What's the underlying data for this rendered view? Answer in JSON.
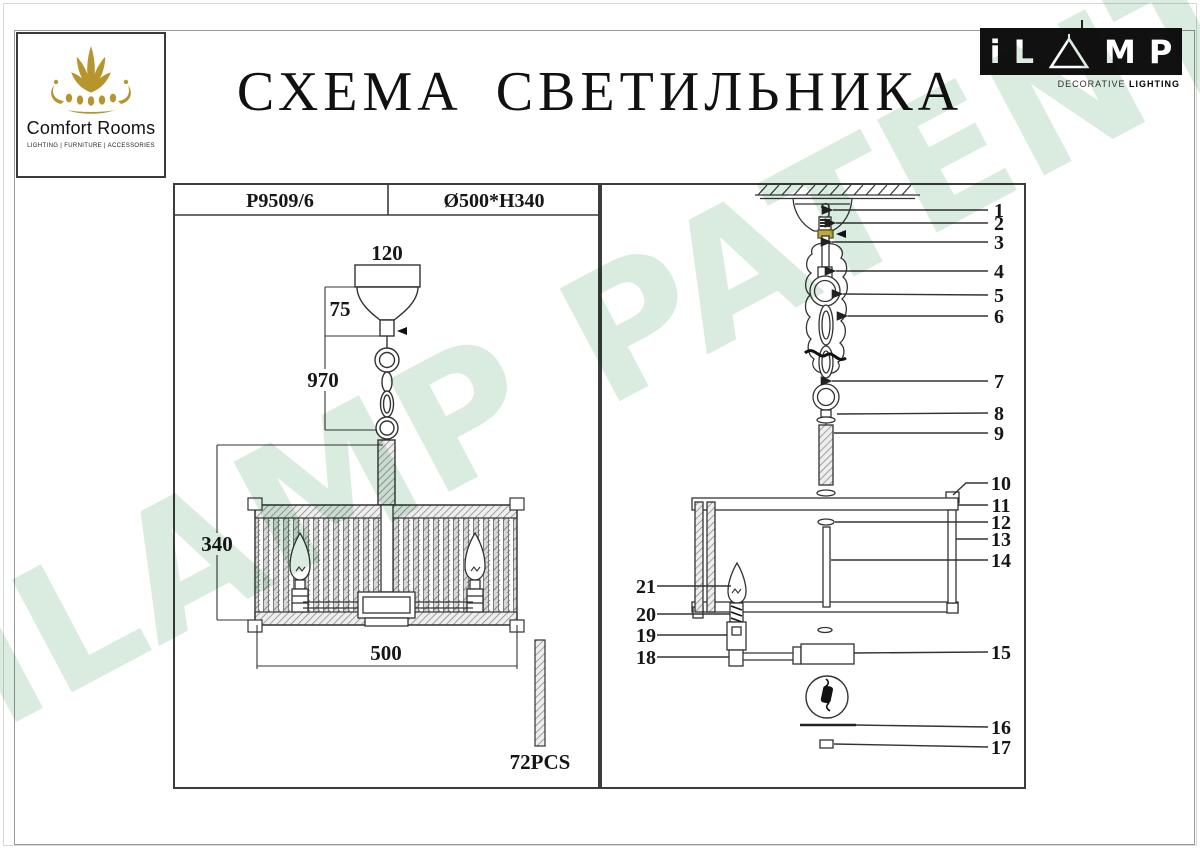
{
  "page": {
    "title": "СХЕМА СВЕТИЛЬНИКА",
    "watermark": "iLAMP PATENTED"
  },
  "comfort_logo": {
    "name": "Comfort Rooms",
    "tagline": "LIGHTING | FURNITURE | ACCESSORIES"
  },
  "ilamp_logo": {
    "letter_i": "i",
    "letter_l": "L",
    "letter_m": "M",
    "letter_p": "P",
    "subtitle_normal": "DECORATIVE ",
    "subtitle_bold": "LIGHTING"
  },
  "spec": {
    "model": "P9509/6",
    "size": "Ø500*H340"
  },
  "left_diagram": {
    "canopy_width": "120",
    "canopy_height": "75",
    "suspension_length": "970",
    "body_height": "340",
    "body_diameter": "500",
    "rod_count": "72PCS"
  },
  "right_diagram": {
    "parts": [
      "1",
      "2",
      "3",
      "4",
      "5",
      "6",
      "7",
      "8",
      "9",
      "10",
      "11",
      "12",
      "13",
      "14",
      "15",
      "16",
      "17",
      "18",
      "19",
      "20",
      "21"
    ]
  },
  "colors": {
    "gold": "#b6952d",
    "ink": "#333333",
    "watermark_green": "#d9ecdf",
    "connector_olive": "#bfa93c"
  }
}
